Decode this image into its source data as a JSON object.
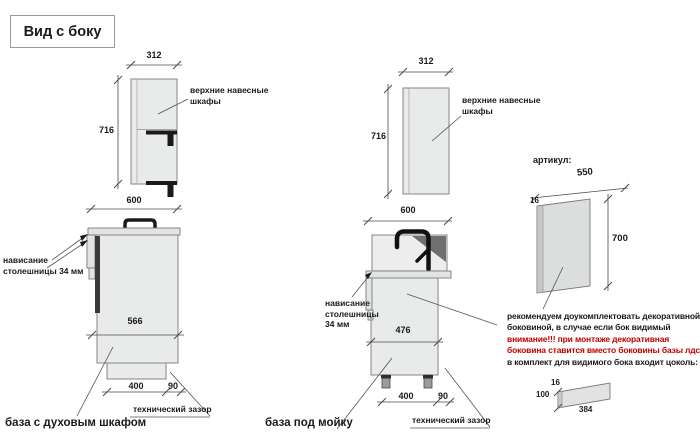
{
  "title": "Вид с боку",
  "colors": {
    "warning_text": "#c00000",
    "cabinet_fill": "#e9eaea",
    "countertop_fill": "#e2e3e3",
    "panel_fill": "#dcdddd",
    "hardware": "#1a1a1a"
  },
  "drawing1": {
    "wall_cabinet": {
      "width_dim": "312",
      "height_dim": "716",
      "label": "верхние навесные\nшкафы"
    },
    "base_cabinet": {
      "width_dim": "600",
      "overhang_label": "нависание\nстолешницы 34 мм",
      "carcass_dim": "566",
      "plinth_dim": "400",
      "gap_dim": "90",
      "gap_label": "технический зазор",
      "caption": "база с духовым шкафом"
    }
  },
  "drawing2": {
    "wall_cabinet": {
      "width_dim": "312",
      "height_dim": "716",
      "label": "верхние навесные\nшкафы"
    },
    "base_cabinet": {
      "width_dim": "600",
      "overhang_label": "нависание\nстолешницы\n34 мм",
      "carcass_dim": "476",
      "plinth_dim": "400",
      "gap_dim": "90",
      "gap_label": "технический зазор",
      "caption": "база под мойку"
    }
  },
  "side_panel": {
    "heading": "артикул:",
    "width_dim": "550",
    "thickness_dim": "16",
    "height_dim": "700",
    "note_line1": "рекомендуем доукомплектовать декоративной",
    "note_line2": "боковиной, в случае если бок видимый",
    "warning_line1": "внимание!!! при монтаже декоративная",
    "warning_line2": "боковина ставится вместо боковины базы лдсп",
    "note_line3": "в комплект для видимого бока входит цоколь:",
    "plinth_strip": {
      "thickness_dim": "16",
      "height_dim": "100",
      "length_dim": "384"
    }
  }
}
